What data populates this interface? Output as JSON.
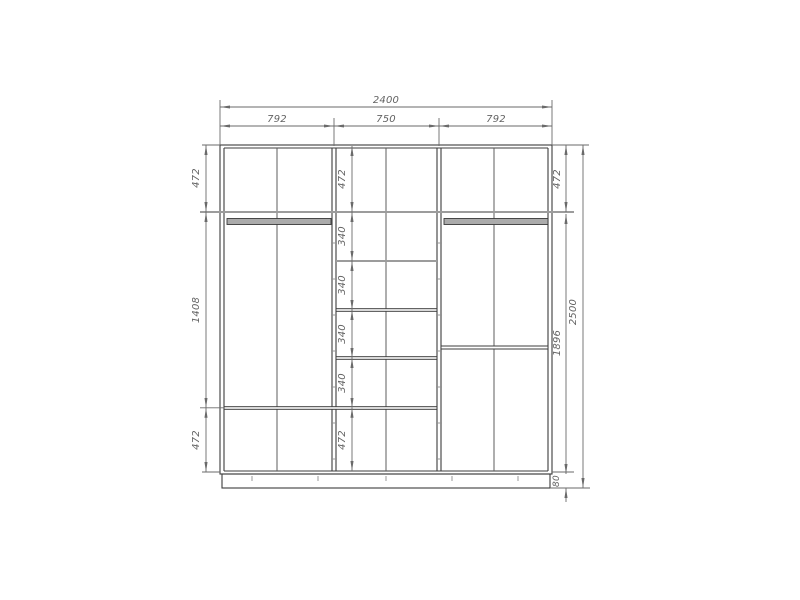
{
  "drawing": {
    "kind": "wardrobe-interior-elevation",
    "dims": {
      "total_width": "2400",
      "section_widths": [
        "792",
        "750",
        "792"
      ],
      "left_col": [
        "472",
        "1408",
        "472"
      ],
      "center_col": [
        "472",
        "340",
        "340",
        "340",
        "340",
        "472"
      ],
      "right_col": [
        "472",
        "1896",
        "80"
      ],
      "total_height": "2500"
    },
    "colors": {
      "background": "#ffffff",
      "structure_line": "#3d3d3d",
      "divider_line": "#5c5c5c",
      "dimension_line": "#6a6a6a",
      "shelf_gray": "#9c9c9c",
      "rod_fill": "#ababab",
      "text": "#636363"
    }
  }
}
